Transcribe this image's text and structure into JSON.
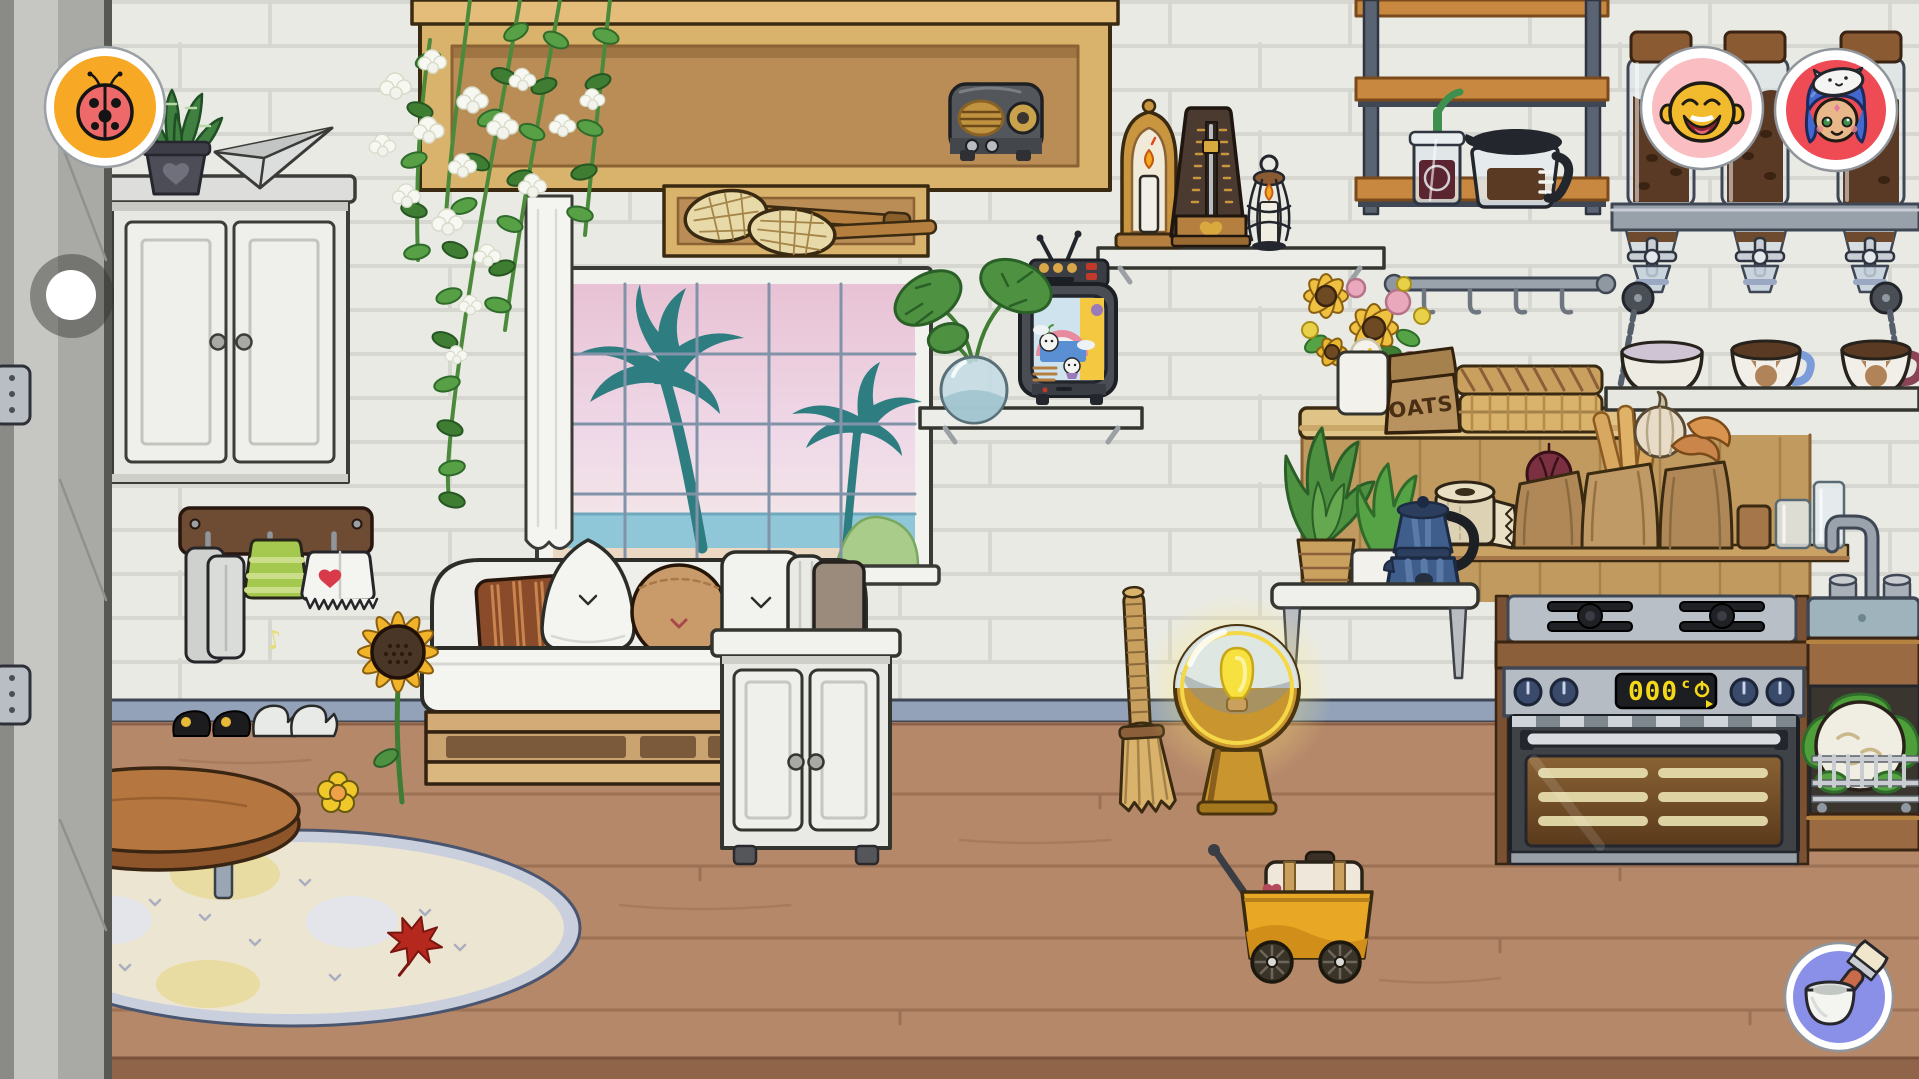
{
  "app": {
    "type": "kids-life-game",
    "scene": "kitchen-living-room"
  },
  "hud": {
    "pet_button": {
      "icon": "ladybug-icon",
      "bg_color": "#F7A824",
      "ring_color": "#FFFFFF"
    },
    "nav_handle": {
      "icon": "drag-handle-dot-icon",
      "color": "#FFFFFF"
    },
    "character_buttons": [
      {
        "icon": "character-yellow-face-icon",
        "bg_color": "#F9BDC2"
      },
      {
        "icon": "character-blue-hair-cat-hat-icon",
        "bg_color": "#EF4B55"
      }
    ],
    "paint_button": {
      "icon": "paint-bucket-brush-icon",
      "bg_color": "#8A90E8"
    }
  },
  "labels": {
    "oats_bag": "OATS",
    "oven_display_value": "000",
    "oven_display_unit": "c",
    "music_note": "♪"
  },
  "palette": {
    "wall": "#E9EAE4",
    "mortar": "#D6D7D1",
    "baseboard": "#93A2B8",
    "floor": "#B5886A",
    "wood_light": "#D9B36B",
    "wood_mid": "#B98D55",
    "wood_dark": "#6E4C33",
    "accent_orange": "#F7A824",
    "accent_red": "#EF4B55",
    "accent_pink": "#F9BDC2",
    "accent_periwinkle": "#8A90E8",
    "leaf_green": "#5FA348",
    "palm_teal": "#2E7D80",
    "sky_pink": "#E8C2D4",
    "sea_blue": "#8FC7D8",
    "oven_digit": "#F5D818"
  },
  "scene_objects": [
    "door-frame",
    "wall-cabinet",
    "succulent-plant",
    "paper-airplane",
    "hanging-flower-vine",
    "overhead-cabinet",
    "vintage-radio",
    "racket-shelf",
    "window-palm-view",
    "curtain",
    "towel-hook-rack",
    "sunflower",
    "daybed-sofa",
    "shoes",
    "round-rug",
    "maple-leaf",
    "coffee-table",
    "firewood-basket",
    "floor-flower",
    "white-cabinet",
    "straw-broom",
    "globe-floor-lamp",
    "toy-wagon-suitcase",
    "retro-tv",
    "monstera-vase",
    "candle-lantern",
    "metronome",
    "wire-candle-lantern",
    "wall-shelf-unit",
    "iced-coffee",
    "coffee-carafe",
    "coffee-bean-jars",
    "bean-dispensers",
    "hook-rail",
    "flower-bouquet-vase",
    "oats-bag",
    "woven-tray",
    "hanging-cup-shelf",
    "bowl",
    "cat-coffee-cups",
    "paper-towel-roll",
    "grocery-bags",
    "drinking-glasses",
    "planter-bench",
    "potted-ferns",
    "moka-pot",
    "gas-cooktop",
    "oven",
    "sink",
    "dishwasher",
    "cauliflower"
  ]
}
